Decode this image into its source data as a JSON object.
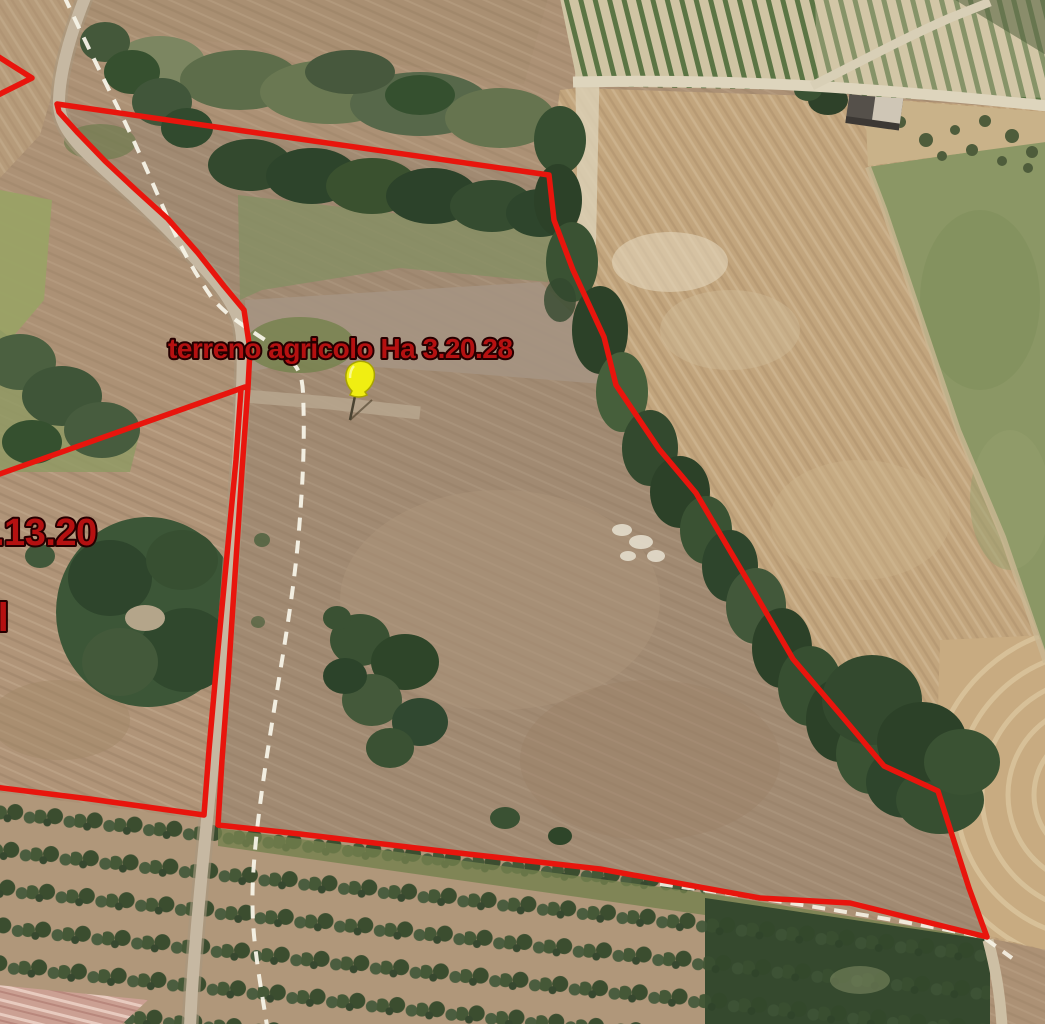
{
  "map": {
    "type": "satellite-aerial-imagery",
    "labels": [
      {
        "id": "main_parcel",
        "text": "terreno agricolo Ha 3.20.28"
      },
      {
        "id": "left_parcel_partial",
        "text": ".13.20"
      },
      {
        "id": "left_edge_fragment",
        "text": "il"
      }
    ],
    "marker": {
      "type": "pushpin",
      "color": "#f0ee12"
    },
    "style": {
      "boundary_color": "#e8150d",
      "label_fill": "#b51111",
      "label_outline": "#250000",
      "dashed_path_color": "#f7f3e7"
    }
  }
}
